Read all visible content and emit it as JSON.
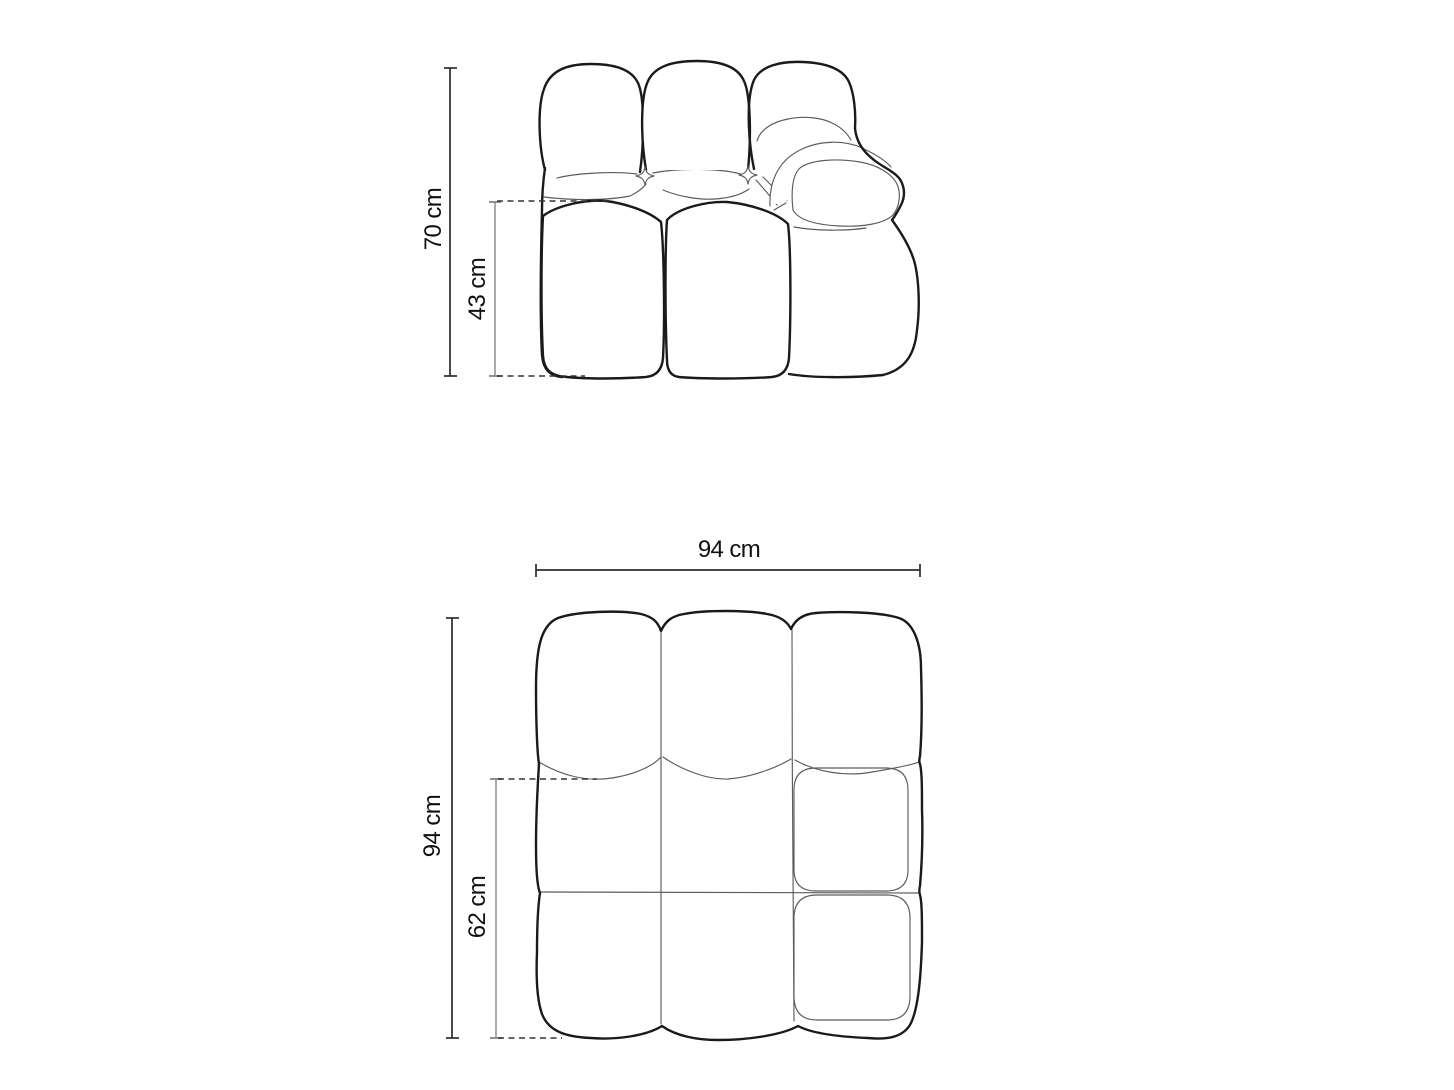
{
  "diagram": {
    "type": "furniture-dimension-drawing",
    "subject": "modular sofa element with right armrest, front elevation and top plan views",
    "views": {
      "front_elevation": {
        "dimensions": {
          "total_height": "70 cm",
          "seat_height": "43 cm"
        }
      },
      "top_plan": {
        "dimensions": {
          "width": "94 cm",
          "total_depth": "94 cm",
          "seat_depth": "62 cm"
        }
      }
    },
    "colors": {
      "background": "#ffffff",
      "outline_bold": "#1a1a1a",
      "outline_thin": "#5c5c5c",
      "dimension_primary": "#2b2b2b",
      "dimension_secondary": "#9b9b9b",
      "dashed_extension": "#333333",
      "text": "#111111"
    }
  }
}
